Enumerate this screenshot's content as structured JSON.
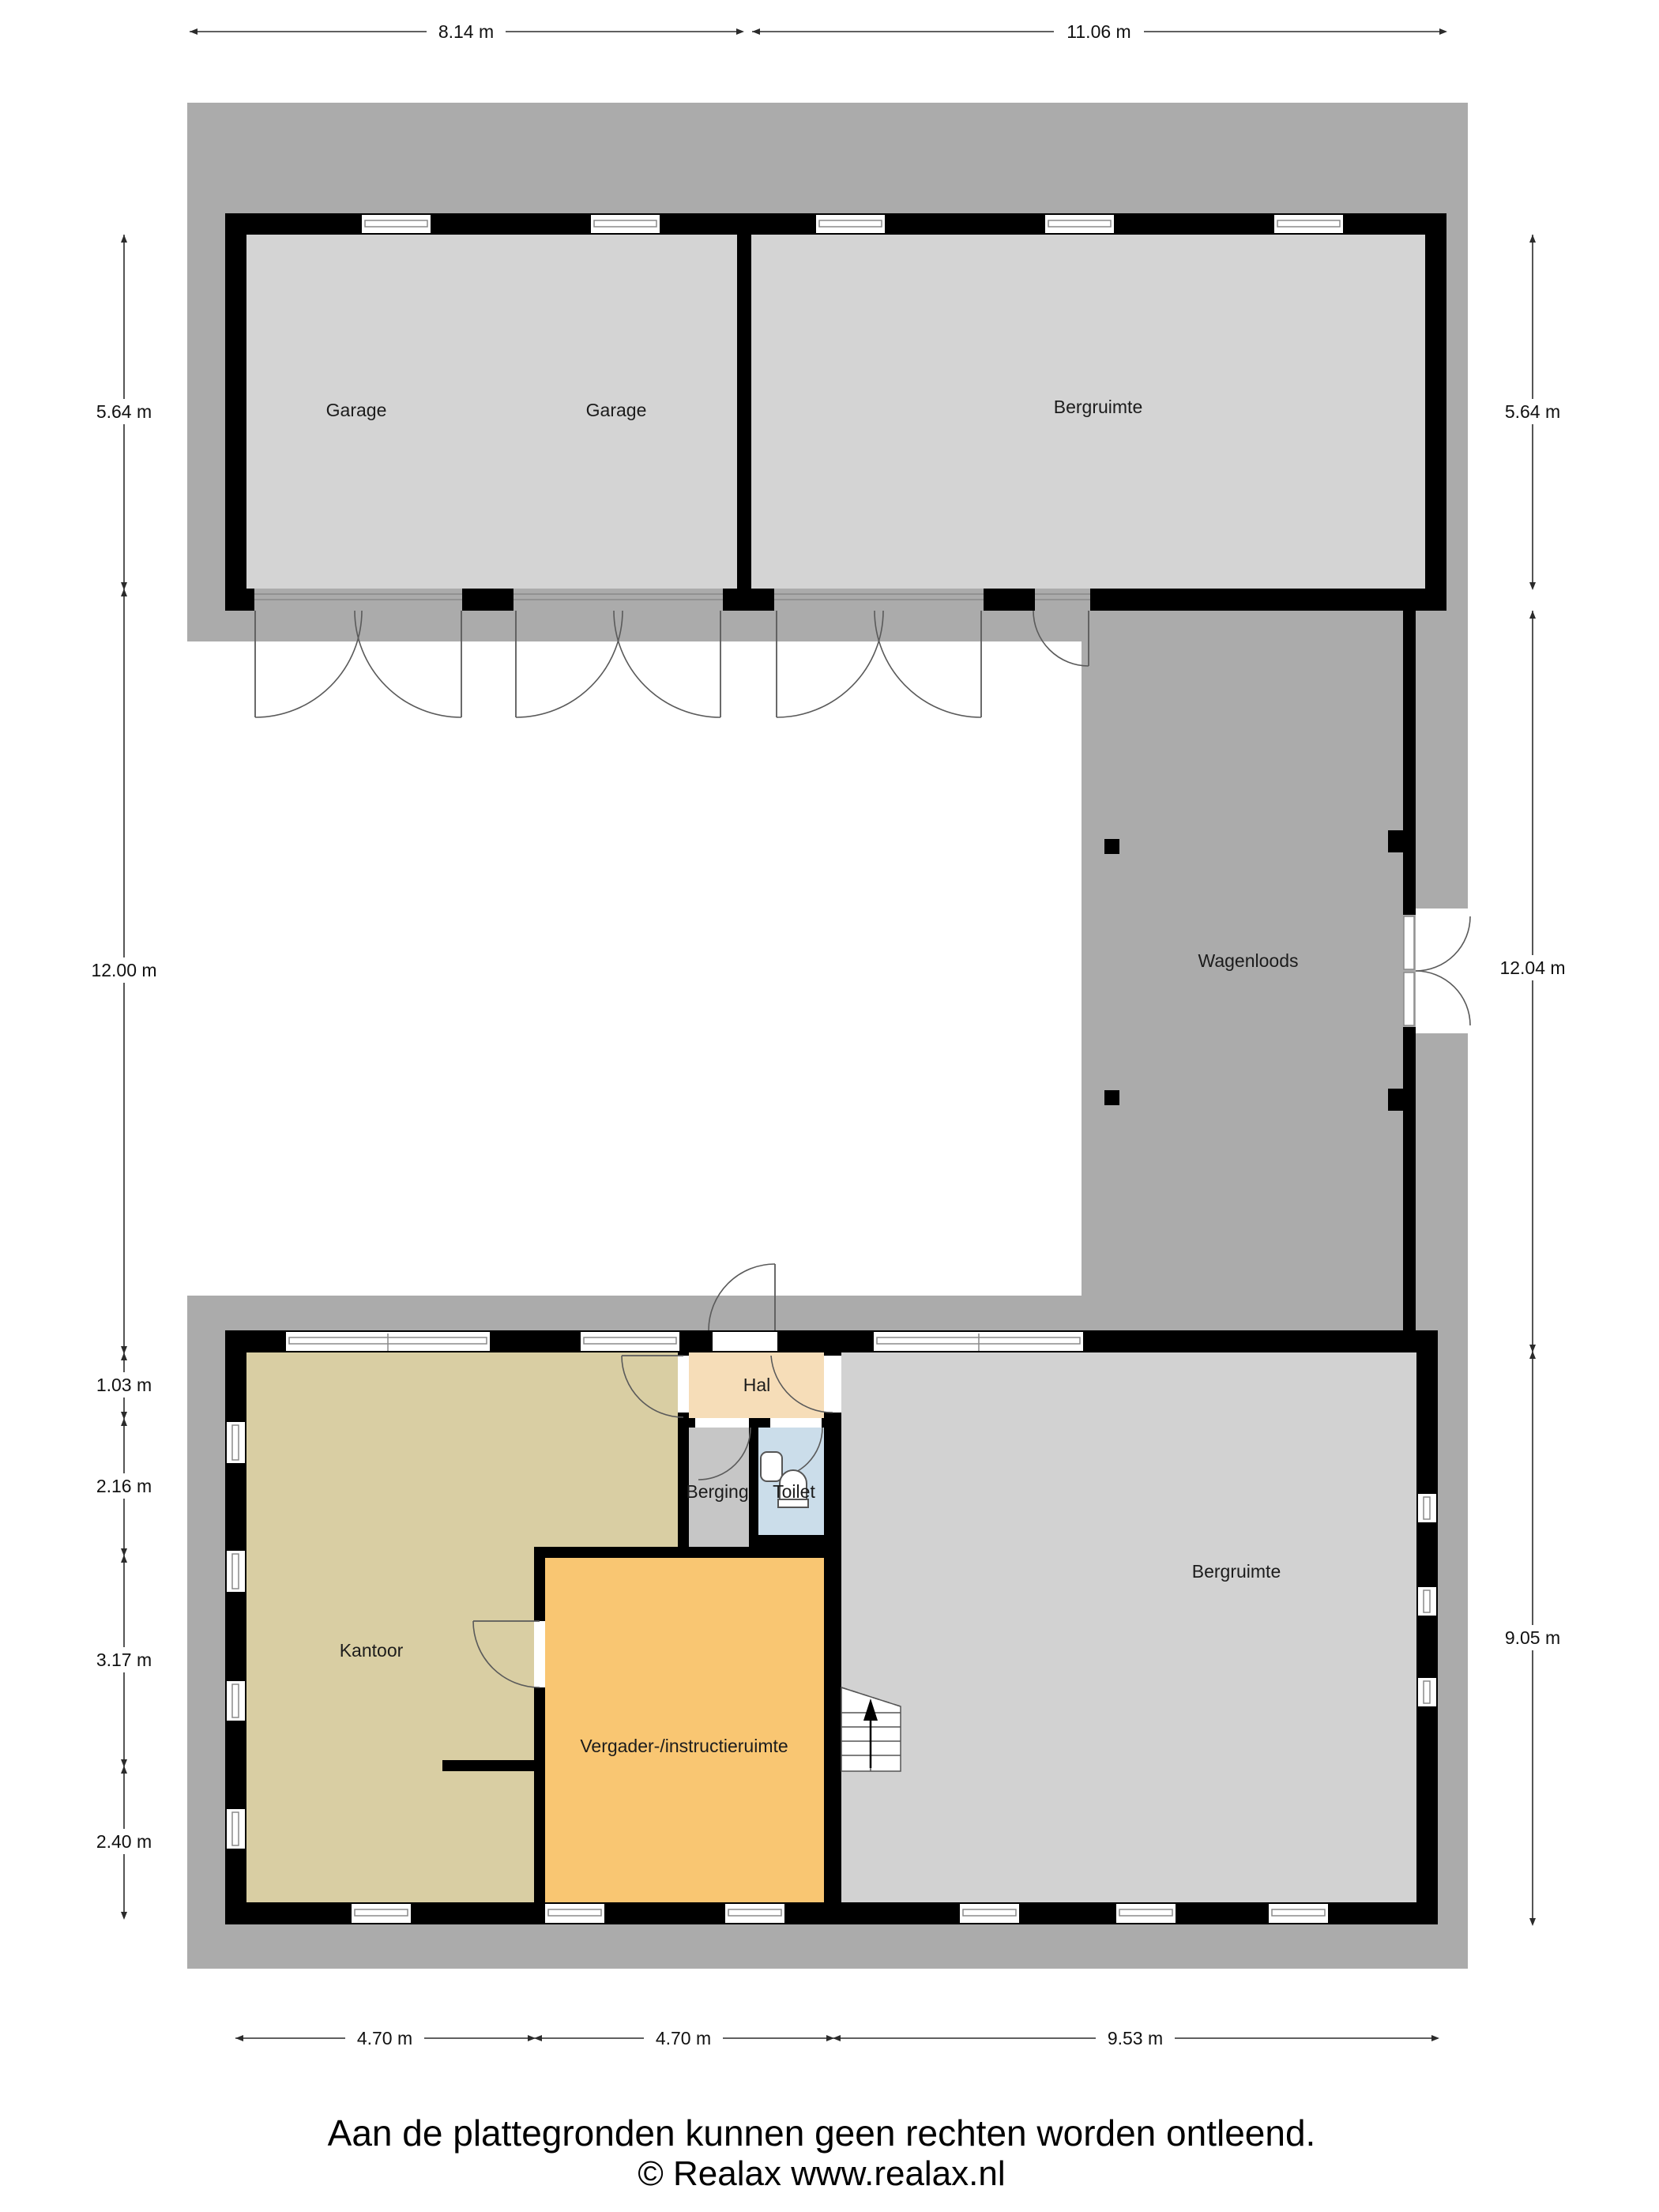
{
  "rooms": {
    "garage_left": {
      "label": "Garage"
    },
    "garage_right": {
      "label": "Garage"
    },
    "bergruimte_top": {
      "label": "Bergruimte"
    },
    "wagenloods": {
      "label": "Wagenloods"
    },
    "hal": {
      "label": "Hal"
    },
    "berging": {
      "label": "Berging"
    },
    "toilet": {
      "label": "Toilet"
    },
    "kantoor": {
      "label": "Kantoor"
    },
    "vergader": {
      "label": "Vergader-/instructieruimte"
    },
    "bergruimte_bottom": {
      "label": "Bergruimte"
    }
  },
  "dimensions": {
    "top": [
      "8.14 m",
      "11.06 m"
    ],
    "left": [
      "5.64 m",
      "12.00 m",
      "1.03 m",
      "2.16 m",
      "3.17 m",
      "2.40 m"
    ],
    "right": [
      "5.64 m",
      "12.04 m",
      "9.05 m"
    ],
    "bottom": [
      "4.70 m",
      "4.70 m",
      "9.53 m"
    ]
  },
  "footer": {
    "disclaimer": "Aan de plattegronden kunnen geen rechten worden ontleend.",
    "copyright": "© Realax www.realax.nl"
  },
  "colors": {
    "terrain": "#ABABAB",
    "floor_garage": "#D4D4D4",
    "floor_bergruimte_top": "#D4D4D4",
    "floor_bergruimte_bottom": "#D2D2D2",
    "floor_kantoor": "#D9CEA3",
    "floor_vergader": "#F9C672",
    "floor_hal": "#F6DDB8",
    "floor_berging": "#C6C6C6",
    "floor_toilet": "#CBDDEA",
    "wall": "#000000"
  }
}
